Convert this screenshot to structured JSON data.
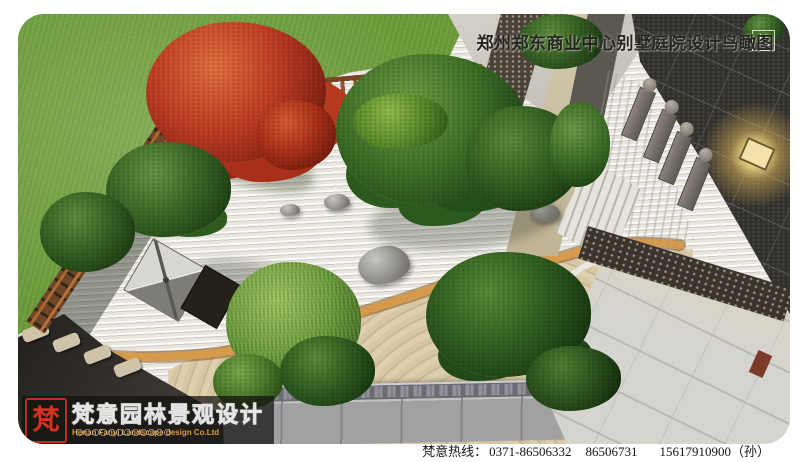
{
  "header": {
    "title": "郑州郑东商业中心别墅庭院设计鸟瞰图",
    "corner_badge": "梵"
  },
  "logo": {
    "seal_text": "梵",
    "brand_text": "梵意园林景观设计",
    "company_en": "Henan Fanyi Landscape design Co.Ltd",
    "decor_dots": "〇〇〇〇〇〇〇〇〇〇〇〇"
  },
  "footer": {
    "hotline_label": "梵意热线：",
    "phones": [
      "0371-86506332",
      "86506731",
      "15617910900（孙）"
    ]
  },
  "palette": {
    "grass": "#6d9d3d",
    "gravel": "#e8e6df",
    "sand": "#d7c7a5",
    "wood_edging": "#d79a4a",
    "fence_wood": "#7a4a28",
    "maple_red": "#bf3c24",
    "foliage_green": "#2f5c20",
    "charcoal_wall": "#31302c",
    "pavement_light": "#d5d4cf",
    "walkway_gray": "#a2a1a2",
    "seal_red": "#cc2a1e",
    "lamp_glow": "#f5d98b"
  }
}
